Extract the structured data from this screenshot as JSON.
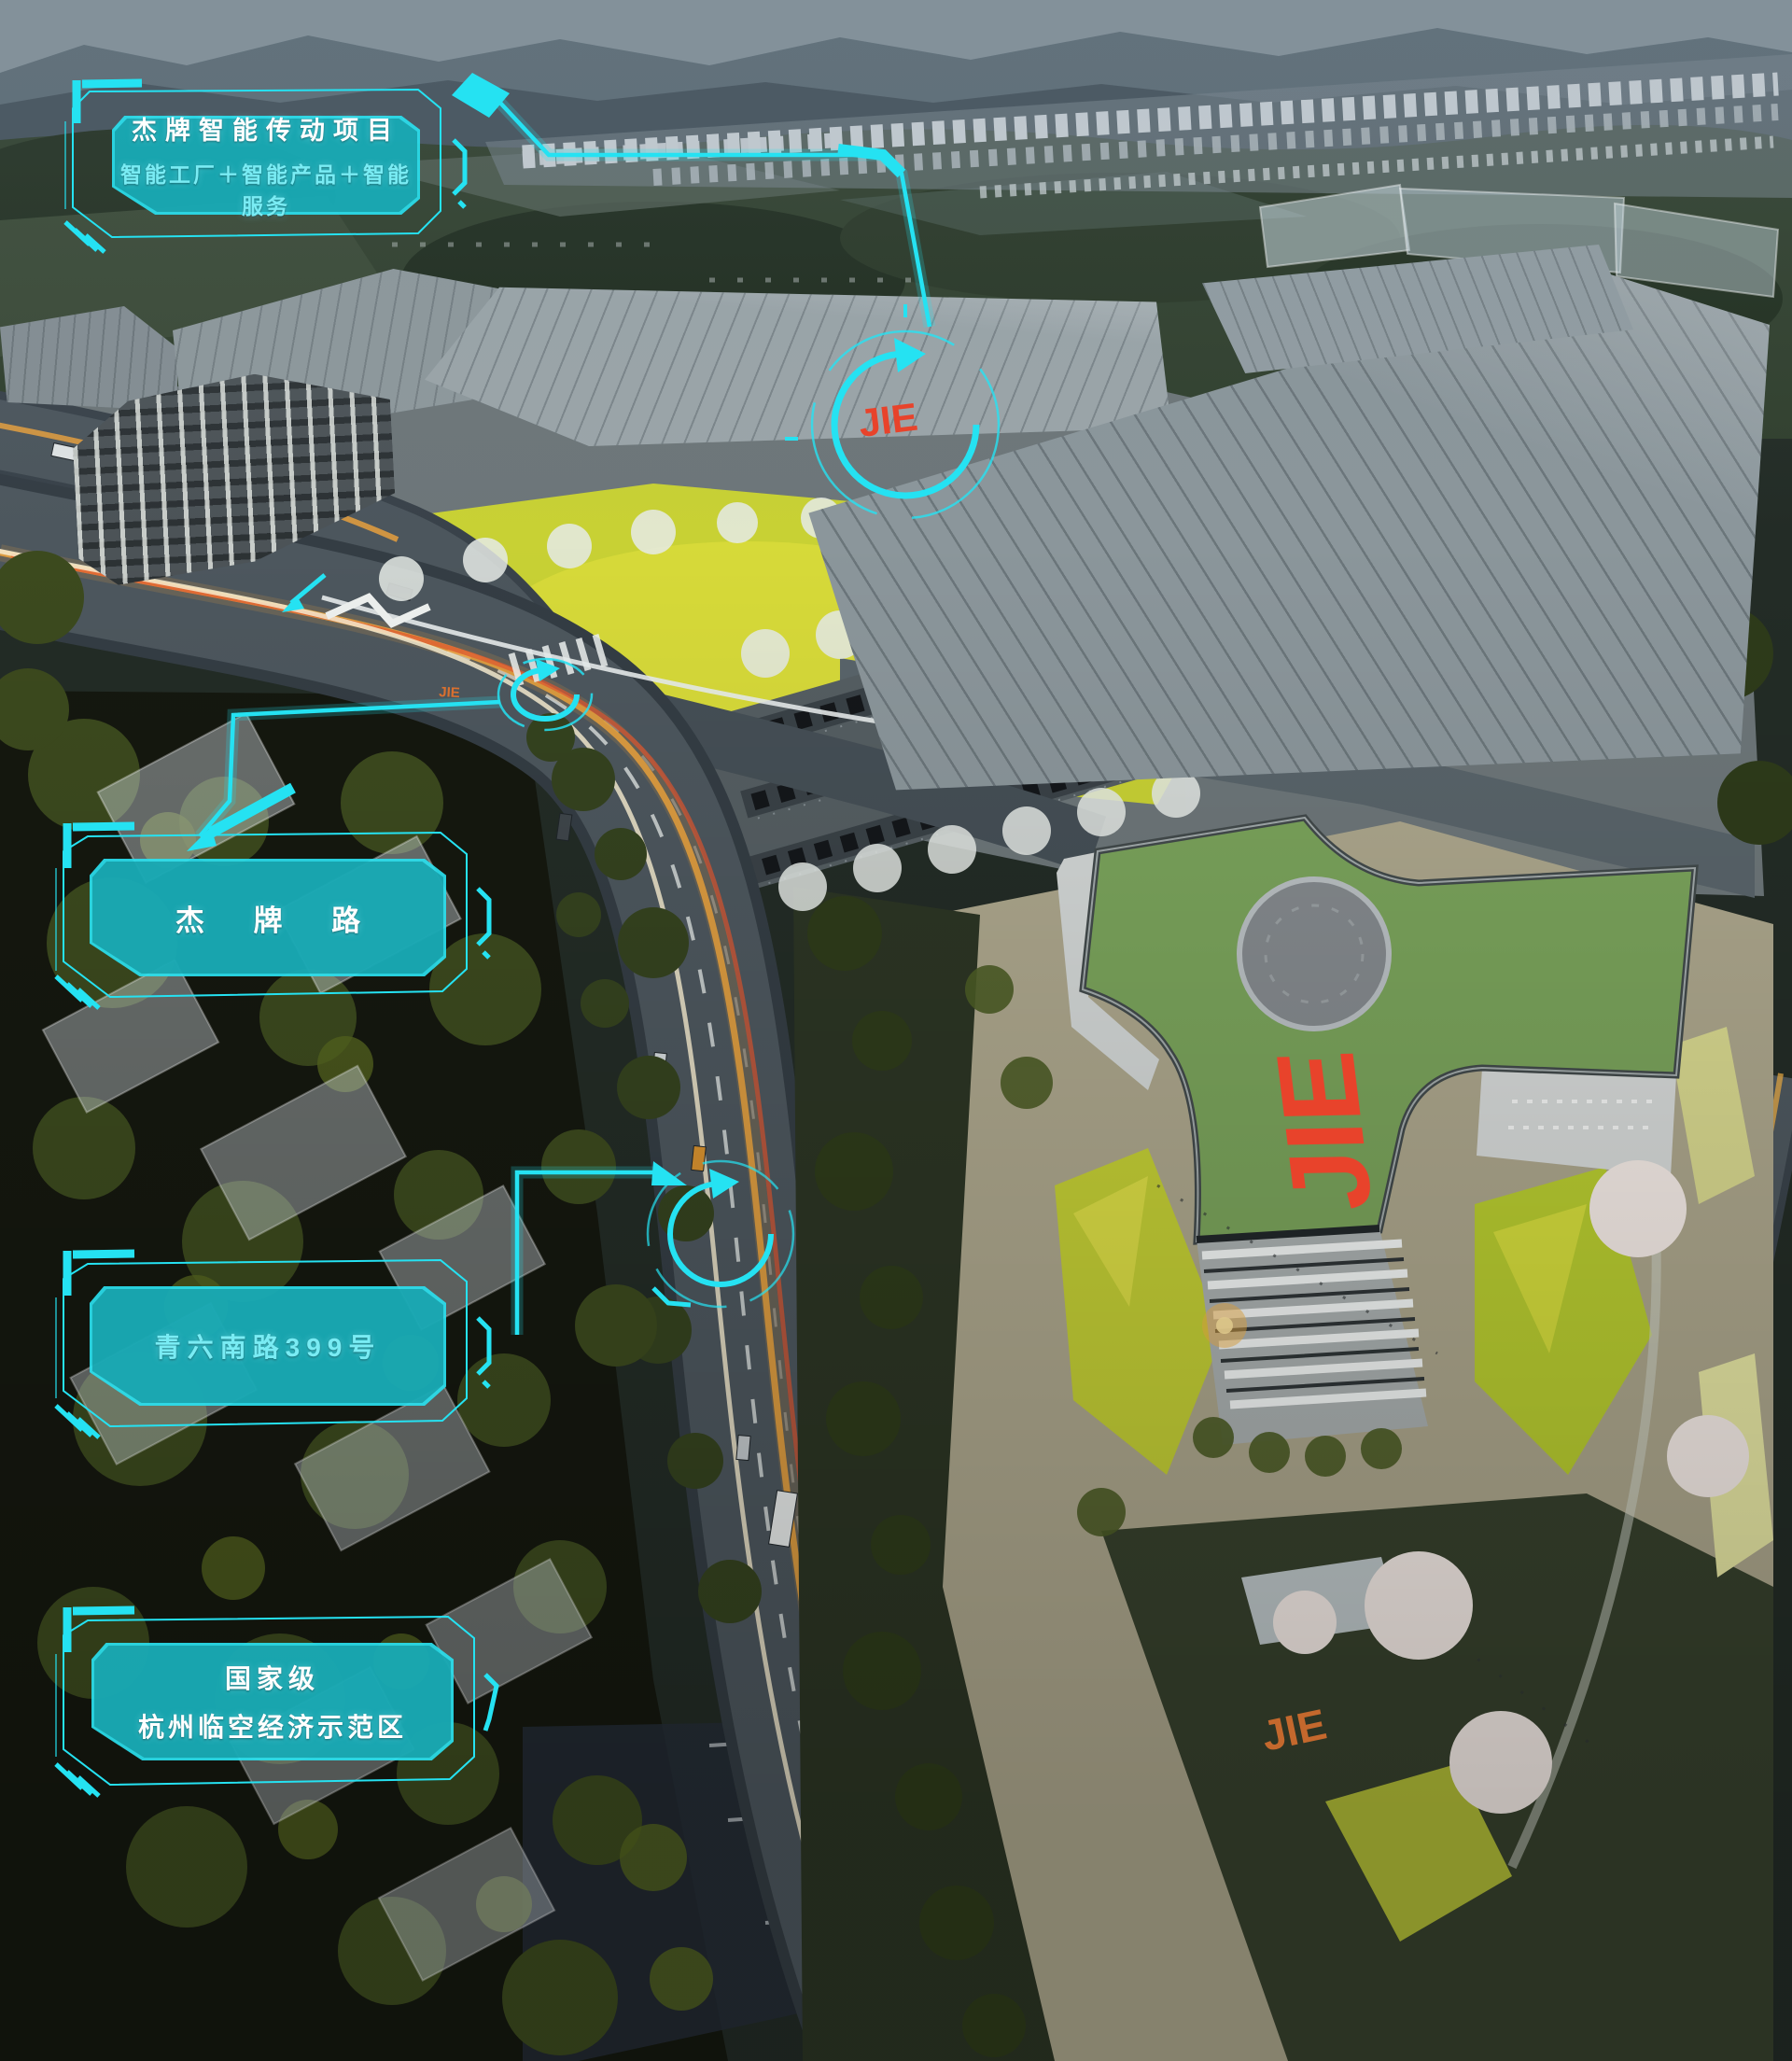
{
  "colors": {
    "accent": "#25e2f2",
    "panel_fill": "rgba(13,132,142,0.58)",
    "logo_red": "#e8432b",
    "logo_orange": "#d9702f",
    "roof_green": "#7aa35b",
    "lawn_yellow": "#c8d134"
  },
  "callouts": [
    {
      "id": "project",
      "lines": [
        "杰牌智能传动项目",
        "智能工厂＋智能产品＋智能服务"
      ]
    },
    {
      "id": "jiepai-road",
      "lines": [
        "杰 牌 路"
      ]
    },
    {
      "id": "qingliu-south-road",
      "lines": [
        "青六南路399号"
      ]
    },
    {
      "id": "national-demo-zone",
      "lines": [
        "国家级",
        "杭州临空经济示范区"
      ]
    }
  ],
  "logos": {
    "roof": "JIE",
    "facade": "JIE",
    "gate": "JIE",
    "ground": "JIE"
  }
}
